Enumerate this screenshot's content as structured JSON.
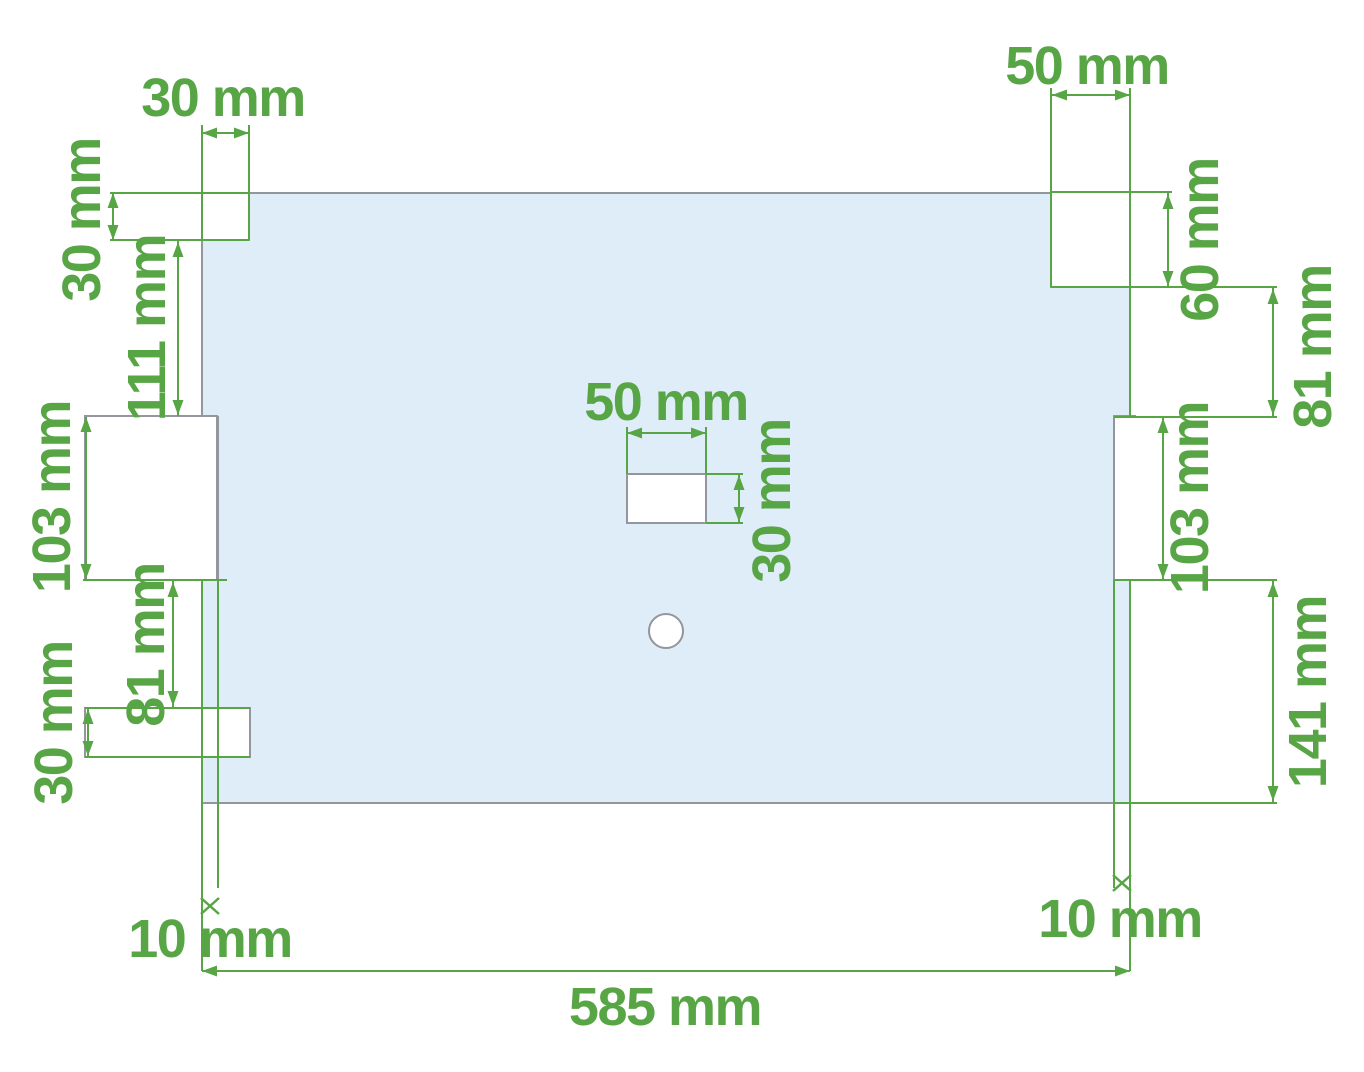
{
  "dimensions": {
    "top_left_notch": {
      "width": "30 mm",
      "height": "30 mm"
    },
    "left_edge": {
      "notch_to_slot": "111 mm",
      "slot_height": "103 mm",
      "slot_to_bottom_notch": "81 mm",
      "bottom_notch_height": "30 mm",
      "slot_depth": "10 mm"
    },
    "center_hole": {
      "width": "50 mm",
      "height": "30 mm"
    },
    "top_right_notch": {
      "width": "50 mm",
      "height": "60 mm"
    },
    "right_edge": {
      "notch_to_slot": "81 mm",
      "slot_height": "103 mm",
      "slot_to_bottom": "141 mm",
      "slot_depth": "10 mm"
    },
    "panel": {
      "width": "585 mm"
    }
  },
  "colors": {
    "dimension_green": "#58a546",
    "panel_fill": "#dfedf8",
    "outline_gray": "#93969d"
  }
}
